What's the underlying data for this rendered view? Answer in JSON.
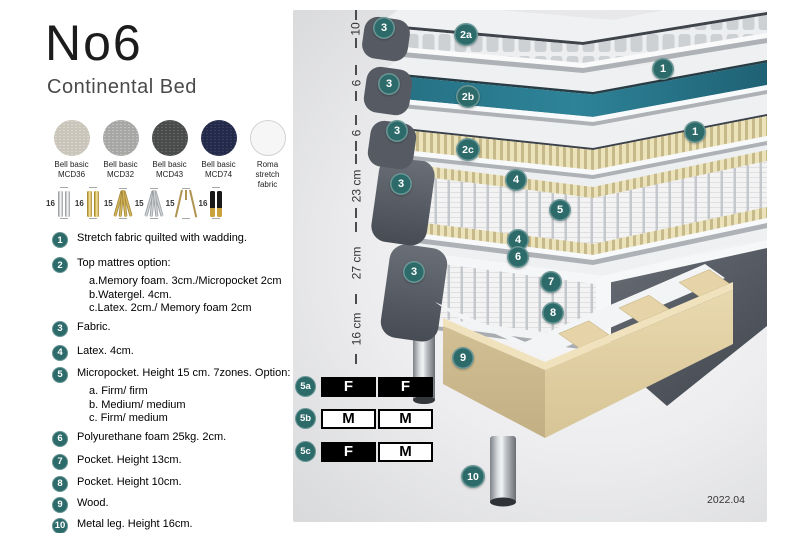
{
  "header": {
    "title": "No6",
    "subtitle": "Continental Bed"
  },
  "fabrics": {
    "items": [
      {
        "name": "Bell basic",
        "code": "MCD36"
      },
      {
        "name": "Bell basic",
        "code": "MCD32"
      },
      {
        "name": "Bell basic",
        "code": "MCD43"
      },
      {
        "name": "Bell basic",
        "code": "MCD74"
      },
      {
        "name": "Roma",
        "code": "stretch fabric"
      }
    ]
  },
  "legs": {
    "items": [
      {
        "size": "16",
        "type": "cylinder-silver"
      },
      {
        "size": "16",
        "type": "cylinder-brass"
      },
      {
        "size": "15",
        "type": "twisted-brass"
      },
      {
        "size": "15",
        "type": "twisted-silver"
      },
      {
        "size": "15",
        "type": "hairpin"
      },
      {
        "size": "16",
        "type": "black-brass"
      }
    ]
  },
  "features": {
    "items": [
      {
        "num": "1",
        "text": "Stretch fabric quilted with wadding."
      },
      {
        "num": "2",
        "text": "Top mattres option:",
        "subs": [
          "a.Memory foam. 3cm./Micropocket 2cm",
          "b.Watergel. 4cm.",
          "c.Latex. 2cm./ Memory foam 2cm"
        ]
      },
      {
        "num": "3",
        "text": "Fabric."
      },
      {
        "num": "4",
        "text": "Latex. 4cm."
      },
      {
        "num": "5",
        "text": "Micropocket. Height 15 cm. 7zones. Option:",
        "subs": [
          "a. Firm/ firm",
          "b. Medium/ medium",
          "c. Firm/ medium"
        ]
      },
      {
        "num": "6",
        "text": "Polyurethane foam 25kg. 2cm."
      },
      {
        "num": "7",
        "text": "Pocket. Height 13cm."
      },
      {
        "num": "8",
        "text": "Pocket. Height 10cm."
      },
      {
        "num": "9",
        "text": "Wood."
      },
      {
        "num": "10",
        "text": "Metal leg. Height 16cm."
      }
    ]
  },
  "diagram": {
    "ruler": [
      {
        "label": "10"
      },
      {
        "label": "6"
      },
      {
        "label": "6"
      },
      {
        "label": "23 cm"
      },
      {
        "label": "27 cm"
      },
      {
        "label": "16 cm"
      }
    ],
    "callouts": [
      {
        "label": "3"
      },
      {
        "label": "2a"
      },
      {
        "label": "1"
      },
      {
        "label": "3"
      },
      {
        "label": "2b"
      },
      {
        "label": "3"
      },
      {
        "label": "2c"
      },
      {
        "label": "1"
      },
      {
        "label": "3"
      },
      {
        "label": "4"
      },
      {
        "label": "5"
      },
      {
        "label": "4"
      },
      {
        "label": "6"
      },
      {
        "label": "3"
      },
      {
        "label": "7"
      },
      {
        "label": "8"
      },
      {
        "label": "9"
      },
      {
        "label": "10"
      }
    ],
    "version": "2022.04"
  },
  "firmness_table": {
    "rows": [
      {
        "label": "5a",
        "cells": [
          {
            "value": "F",
            "variant": "dark"
          },
          {
            "value": "F",
            "variant": "dark"
          }
        ]
      },
      {
        "label": "5b",
        "cells": [
          {
            "value": "M",
            "variant": "light"
          },
          {
            "value": "M",
            "variant": "light"
          }
        ]
      },
      {
        "label": "5c",
        "cells": [
          {
            "value": "F",
            "variant": "dark"
          },
          {
            "value": "M",
            "variant": "light"
          }
        ]
      }
    ]
  },
  "colors": {
    "accent_teal": "#2d6b6a",
    "watergel_teal": "#2e7f93",
    "wood": "#dfcfa5"
  }
}
